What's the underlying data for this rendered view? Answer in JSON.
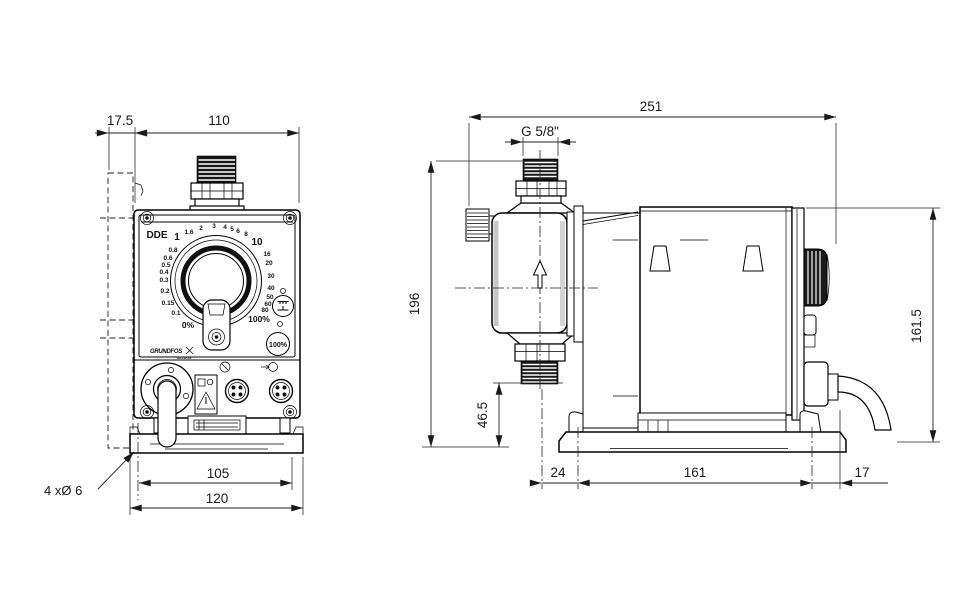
{
  "front_view": {
    "model": "DDE",
    "logo": {
      "brand": "GRUNDFOS",
      "sub": "ALLDOS"
    },
    "dial": {
      "scale": [
        "1",
        "1.6",
        "2",
        "3",
        "4",
        "5",
        "6",
        "8",
        "10",
        "16",
        "20",
        "30",
        "40",
        "50",
        "60",
        "80",
        "0.8",
        "0.6",
        "0.5",
        "0.4",
        "0.3",
        "0.2",
        "0.15",
        "0.1"
      ],
      "min": "0%",
      "max": "100%"
    },
    "buttons": {
      "capacity": "100%"
    },
    "dims": {
      "bracket_depth": "17.5",
      "width": "110",
      "hole_spacing": "105",
      "base_width": "120",
      "holes": "4 xØ 6"
    }
  },
  "side_view": {
    "dims": {
      "length": "251",
      "thread": "G 5/8\"",
      "height": "196",
      "valve_height": "46.5",
      "rear_height": "161.5",
      "front_offset": "24",
      "hole_spacing": "161",
      "rear_offset": "17"
    }
  }
}
